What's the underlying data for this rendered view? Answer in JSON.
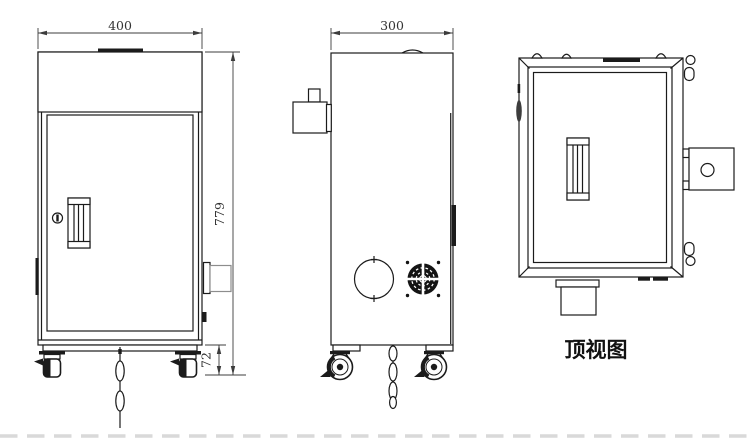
{
  "views": {
    "front": {
      "dimensions": {
        "width": "400",
        "height": "779",
        "caster_height": "72"
      }
    },
    "side": {
      "dimensions": {
        "depth": "300"
      }
    },
    "top": {
      "caption": "顶视图"
    }
  },
  "colors": {
    "line": "#1b1b1b",
    "gray_line": "#8d8d8d",
    "dim_text": "#333333",
    "page_dash": "#d9d9d9",
    "background": "#ffffff"
  }
}
